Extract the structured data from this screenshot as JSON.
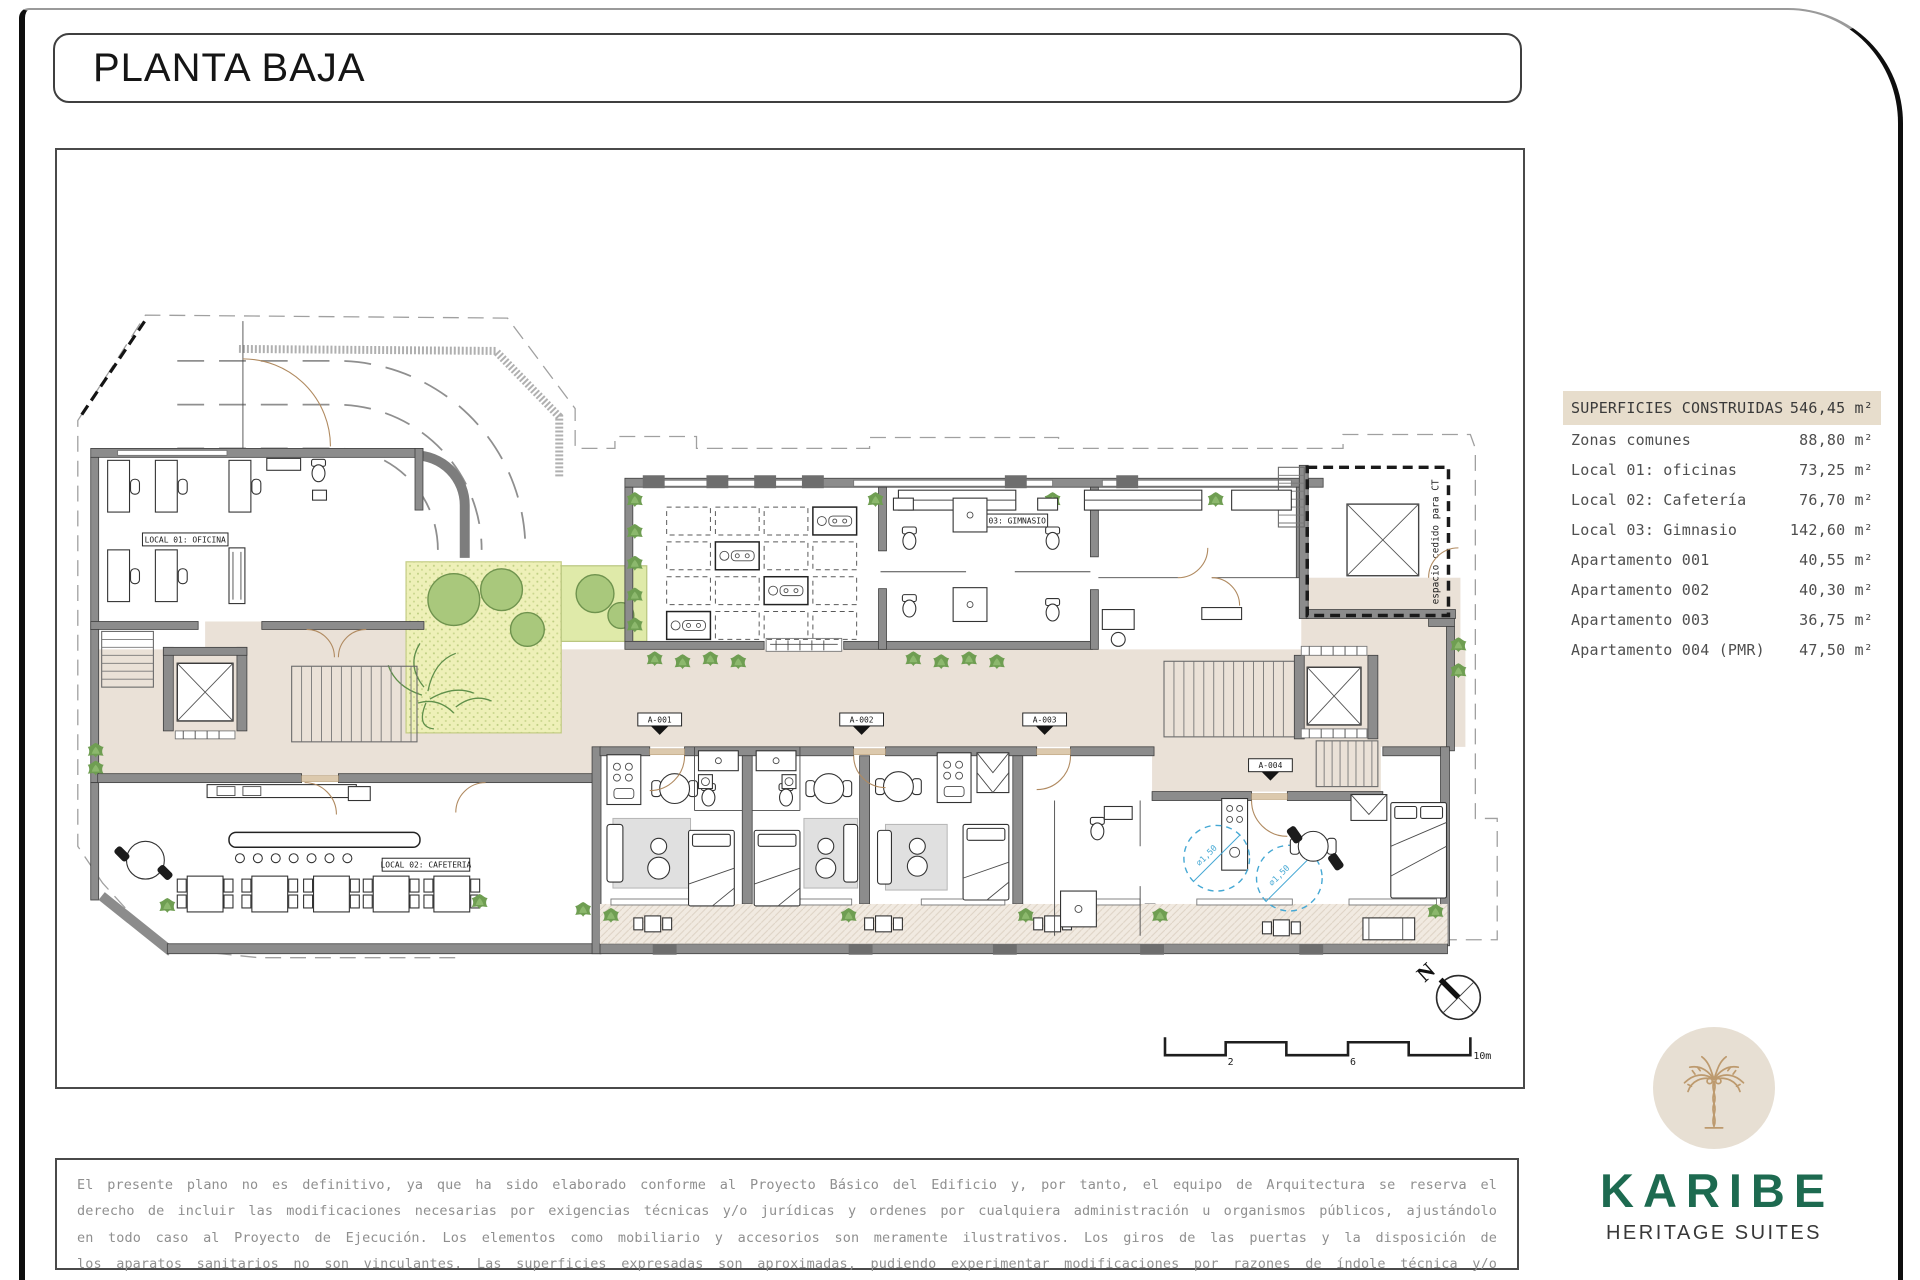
{
  "title": "PLANTA BAJA",
  "surfaces_table": {
    "header": {
      "label": "SUPERFICIES CONSTRUIDAS",
      "value": "546,45 m²"
    },
    "rows": [
      {
        "label": "Zonas comunes",
        "value": "88,80 m²"
      },
      {
        "label": "Local 01:  oficinas",
        "value": "73,25 m²"
      },
      {
        "label": "Local 02:  Cafetería",
        "value": "76,70 m²"
      },
      {
        "label": "Local 03:  Gimnasio",
        "value": "142,60 m²"
      },
      {
        "label": "Apartamento 001",
        "value": "40,55 m²"
      },
      {
        "label": "Apartamento 002",
        "value": "40,30 m²"
      },
      {
        "label": "Apartamento 003",
        "value": "36,75 m²"
      },
      {
        "label": "Apartamento 004 (PMR)",
        "value": "47,50 m²"
      }
    ]
  },
  "plan": {
    "room_labels": {
      "local01": "LOCAL 01:  OFICINA",
      "local02": "LOCAL 02:  CAFETERIA",
      "local03": "LOCAL 03: GIMNASIO",
      "apt001": "A-001",
      "apt002": "A-002",
      "apt003": "A-003",
      "apt004": "A-004",
      "ct_space": "espacio cedido para CT",
      "pmr_diameter": "⌀1,50"
    },
    "north_label": "N",
    "scale": {
      "tick2": "2",
      "tick6": "6",
      "tick10": "10m"
    }
  },
  "disclaimer": "El presente plano no es definitivo, ya que ha sido elaborado conforme al Proyecto Básico del Edificio y, por tanto, el equipo de Arquitectura se reserva el derecho de incluir las modificaciones necesarias por exigencias técnicas y/o jurídicas y ordenes por cualquiera administración u organismos públicos, ajustándolo en todo caso al Proyecto de Ejecución. Los elementos como mobiliario y accesorios son meramente ilustrativos. Los giros de las puertas y la disposición de los aparatos sanitarios no son vinculantes. Las superficies expresadas son aproximadas, pudiendo experimentar modificaciones por razones de índole técnica y/o legal en el Proyecto de Ejecución.",
  "brand": {
    "name": "KARIBE",
    "tagline": "HERITAGE SUITES"
  },
  "colors": {
    "brand_green": "#1d6a50",
    "logo_beige": "#e7dfd3",
    "palm_tan": "#bd9a6e",
    "corridor_beige": "#eae1d7",
    "garden_yellow": "#eef0b8",
    "plant_green": "#7fae62",
    "table_header_bg": "#e7ddcc",
    "pmr_blue": "#45a8d4"
  }
}
